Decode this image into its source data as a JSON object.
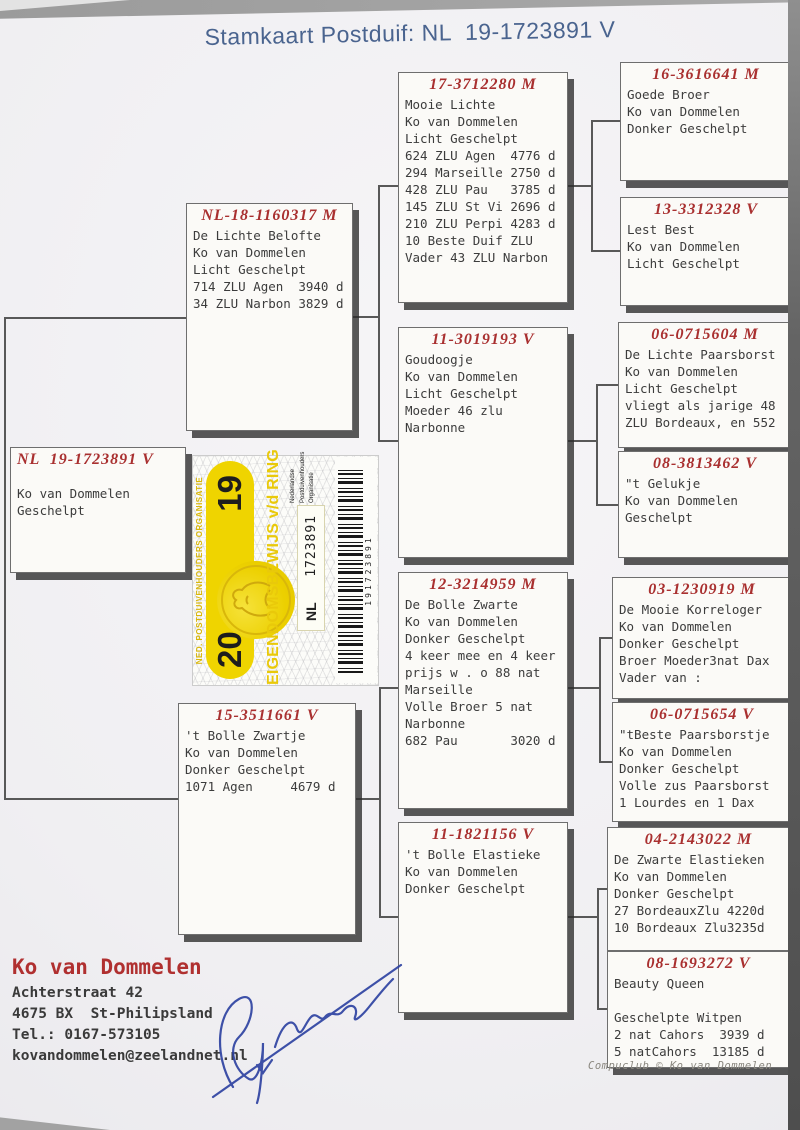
{
  "title": "Stamkaart Postduif: NL  19-1723891 V",
  "pedigree": {
    "subject": {
      "ring": "NL  19-1723891 V",
      "lines": [
        "Ko van Dommelen",
        "Geschelpt"
      ]
    },
    "gen2": [
      {
        "ring": "NL-18-1160317 M",
        "lines": [
          "De Lichte Belofte",
          "Ko van Dommelen",
          "Licht Geschelpt",
          "714 ZLU Agen  3940 d",
          "34 ZLU Narbon 3829 d"
        ]
      },
      {
        "ring": "15-3511661 V",
        "lines": [
          "'t Bolle Zwartje",
          "Ko van Dommelen",
          "Donker Geschelpt",
          "1071 Agen     4679 d"
        ]
      }
    ],
    "gen3": [
      {
        "ring": "17-3712280 M",
        "lines": [
          "Mooie Lichte",
          "Ko van Dommelen",
          "Licht Geschelpt",
          "624 ZLU Agen  4776 d",
          "294 Marseille 2750 d",
          "428 ZLU Pau   3785 d",
          "145 ZLU St Vi 2696 d",
          "210 ZLU Perpi 4283 d",
          "10 Beste Duif ZLU",
          "Vader 43 ZLU Narbon"
        ]
      },
      {
        "ring": "11-3019193 V",
        "lines": [
          "Goudoogje",
          "Ko van Dommelen",
          "Licht Geschelpt",
          "Moeder 46 zlu",
          "Narbonne"
        ]
      },
      {
        "ring": "12-3214959 M",
        "lines": [
          "De Bolle Zwarte",
          "Ko van Dommelen",
          "Donker Geschelpt",
          "4 keer mee en 4 keer",
          "prijs w . o 88 nat",
          "Marseille",
          "Volle Broer 5 nat",
          "Narbonne",
          "682 Pau       3020 d"
        ]
      },
      {
        "ring": "11-1821156 V",
        "lines": [
          "'t Bolle Elastieke",
          "Ko van Dommelen",
          "Donker Geschelpt"
        ]
      }
    ],
    "gen4": [
      {
        "ring": "16-3616641 M",
        "lines": [
          "Goede Broer",
          "Ko van Dommelen",
          "Donker Geschelpt"
        ]
      },
      {
        "ring": "13-3312328 V",
        "lines": [
          "Lest Best",
          "Ko van Dommelen",
          "Licht Geschelpt"
        ]
      },
      {
        "ring": "06-0715604 M",
        "lines": [
          "De Lichte Paarsborst",
          "Ko van Dommelen",
          "Licht Geschelpt",
          "vliegt als jarige 48",
          "ZLU Bordeaux, en 552"
        ]
      },
      {
        "ring": "08-3813462 V",
        "lines": [
          "\"t Gelukje",
          "Ko van Dommelen",
          "Geschelpt"
        ]
      },
      {
        "ring": "03-1230919 M",
        "lines": [
          "De Mooie Korreloger",
          "Ko van Dommelen",
          "Donker Geschelpt",
          "Broer Moeder3nat Dax",
          "Vader van :"
        ]
      },
      {
        "ring": "06-0715654 V",
        "lines": [
          "\"tBeste Paarsborstje",
          "Ko van Dommelen",
          "Donker Geschelpt",
          "Volle zus Paarsborst",
          "1 Lourdes en 1 Dax"
        ]
      },
      {
        "ring": "04-2143022 M",
        "lines": [
          "De Zwarte Elastieken",
          "Ko van Dommelen",
          "Donker Geschelpt",
          "27 BordeauxZlu 4220d",
          "10 Bordeaux Zlu3235d"
        ]
      },
      {
        "ring": "08-1693272 V",
        "lines": [
          "Beauty Queen",
          "",
          "Geschelpte Witpen",
          "2 nat Cahors  3939 d",
          "5 natCahors  13185 d"
        ]
      }
    ]
  },
  "owner": {
    "name": "Ko van Dommelen",
    "lines": [
      "Achterstraat 42",
      "4675 BX  St-Philipsland",
      "Tel.: 0167-573105",
      "kovandommelen@zeelandnet.nl"
    ]
  },
  "ring_sticker": {
    "org_header": "NED. POSTDUIVENHOUDERS ORGANISATIE",
    "year_left": "20",
    "year_right": "19",
    "main_text": "EIGENDOMSBEWIJS v/d RING",
    "country": "NL",
    "ring_number": "1723891",
    "npo_lines": [
      "Nederlandse",
      "Postduivenhouders",
      "Organisatie"
    ],
    "barcode_number": "191723891",
    "colors": {
      "yellow": "#efd400",
      "black": "#1d1d1d"
    }
  },
  "footer_credit": "Compuclub © Ko van Dommelen",
  "colors": {
    "title_blue": "#4a648f",
    "ring_red": "#a93030",
    "body_text": "#3c3c3c",
    "paper": "#f1f0f3"
  }
}
